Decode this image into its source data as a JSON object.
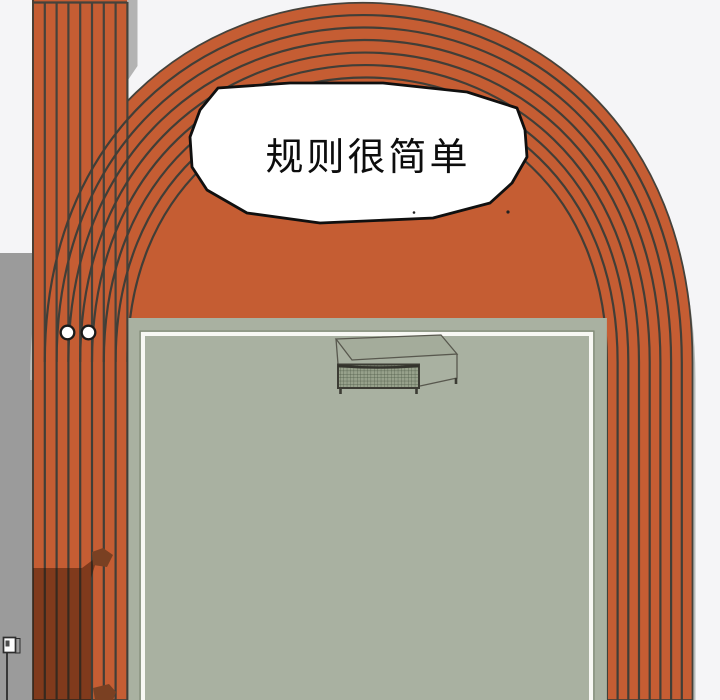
{
  "comic_panel": {
    "speech_bubble": {
      "text": "规则很简单"
    },
    "scene": {
      "track_lane_count": 8,
      "start_marker_count": 2,
      "elements": [
        "running-track",
        "sprint-straight-extension",
        "soccer-field",
        "soccer-goal",
        "start-marker-dots",
        "ground-shadow",
        "small-sign",
        "speech-bubble"
      ]
    },
    "colors": {
      "track": "#c55d33",
      "lane_line": "#413e37",
      "field": "#a9b1a1",
      "field_line": "#f8f8f4",
      "background": "#f5f5f7",
      "left_strip": "#9b9b9b",
      "track_border": "#b9bcb9",
      "cast_shadow": "#2d0f00",
      "shadow_blob": "#7a4022",
      "goal_net": "#97a18b",
      "bubble_fill": "#ffffff",
      "bubble_outline": "#101010",
      "text": "#0d0d0d"
    }
  }
}
